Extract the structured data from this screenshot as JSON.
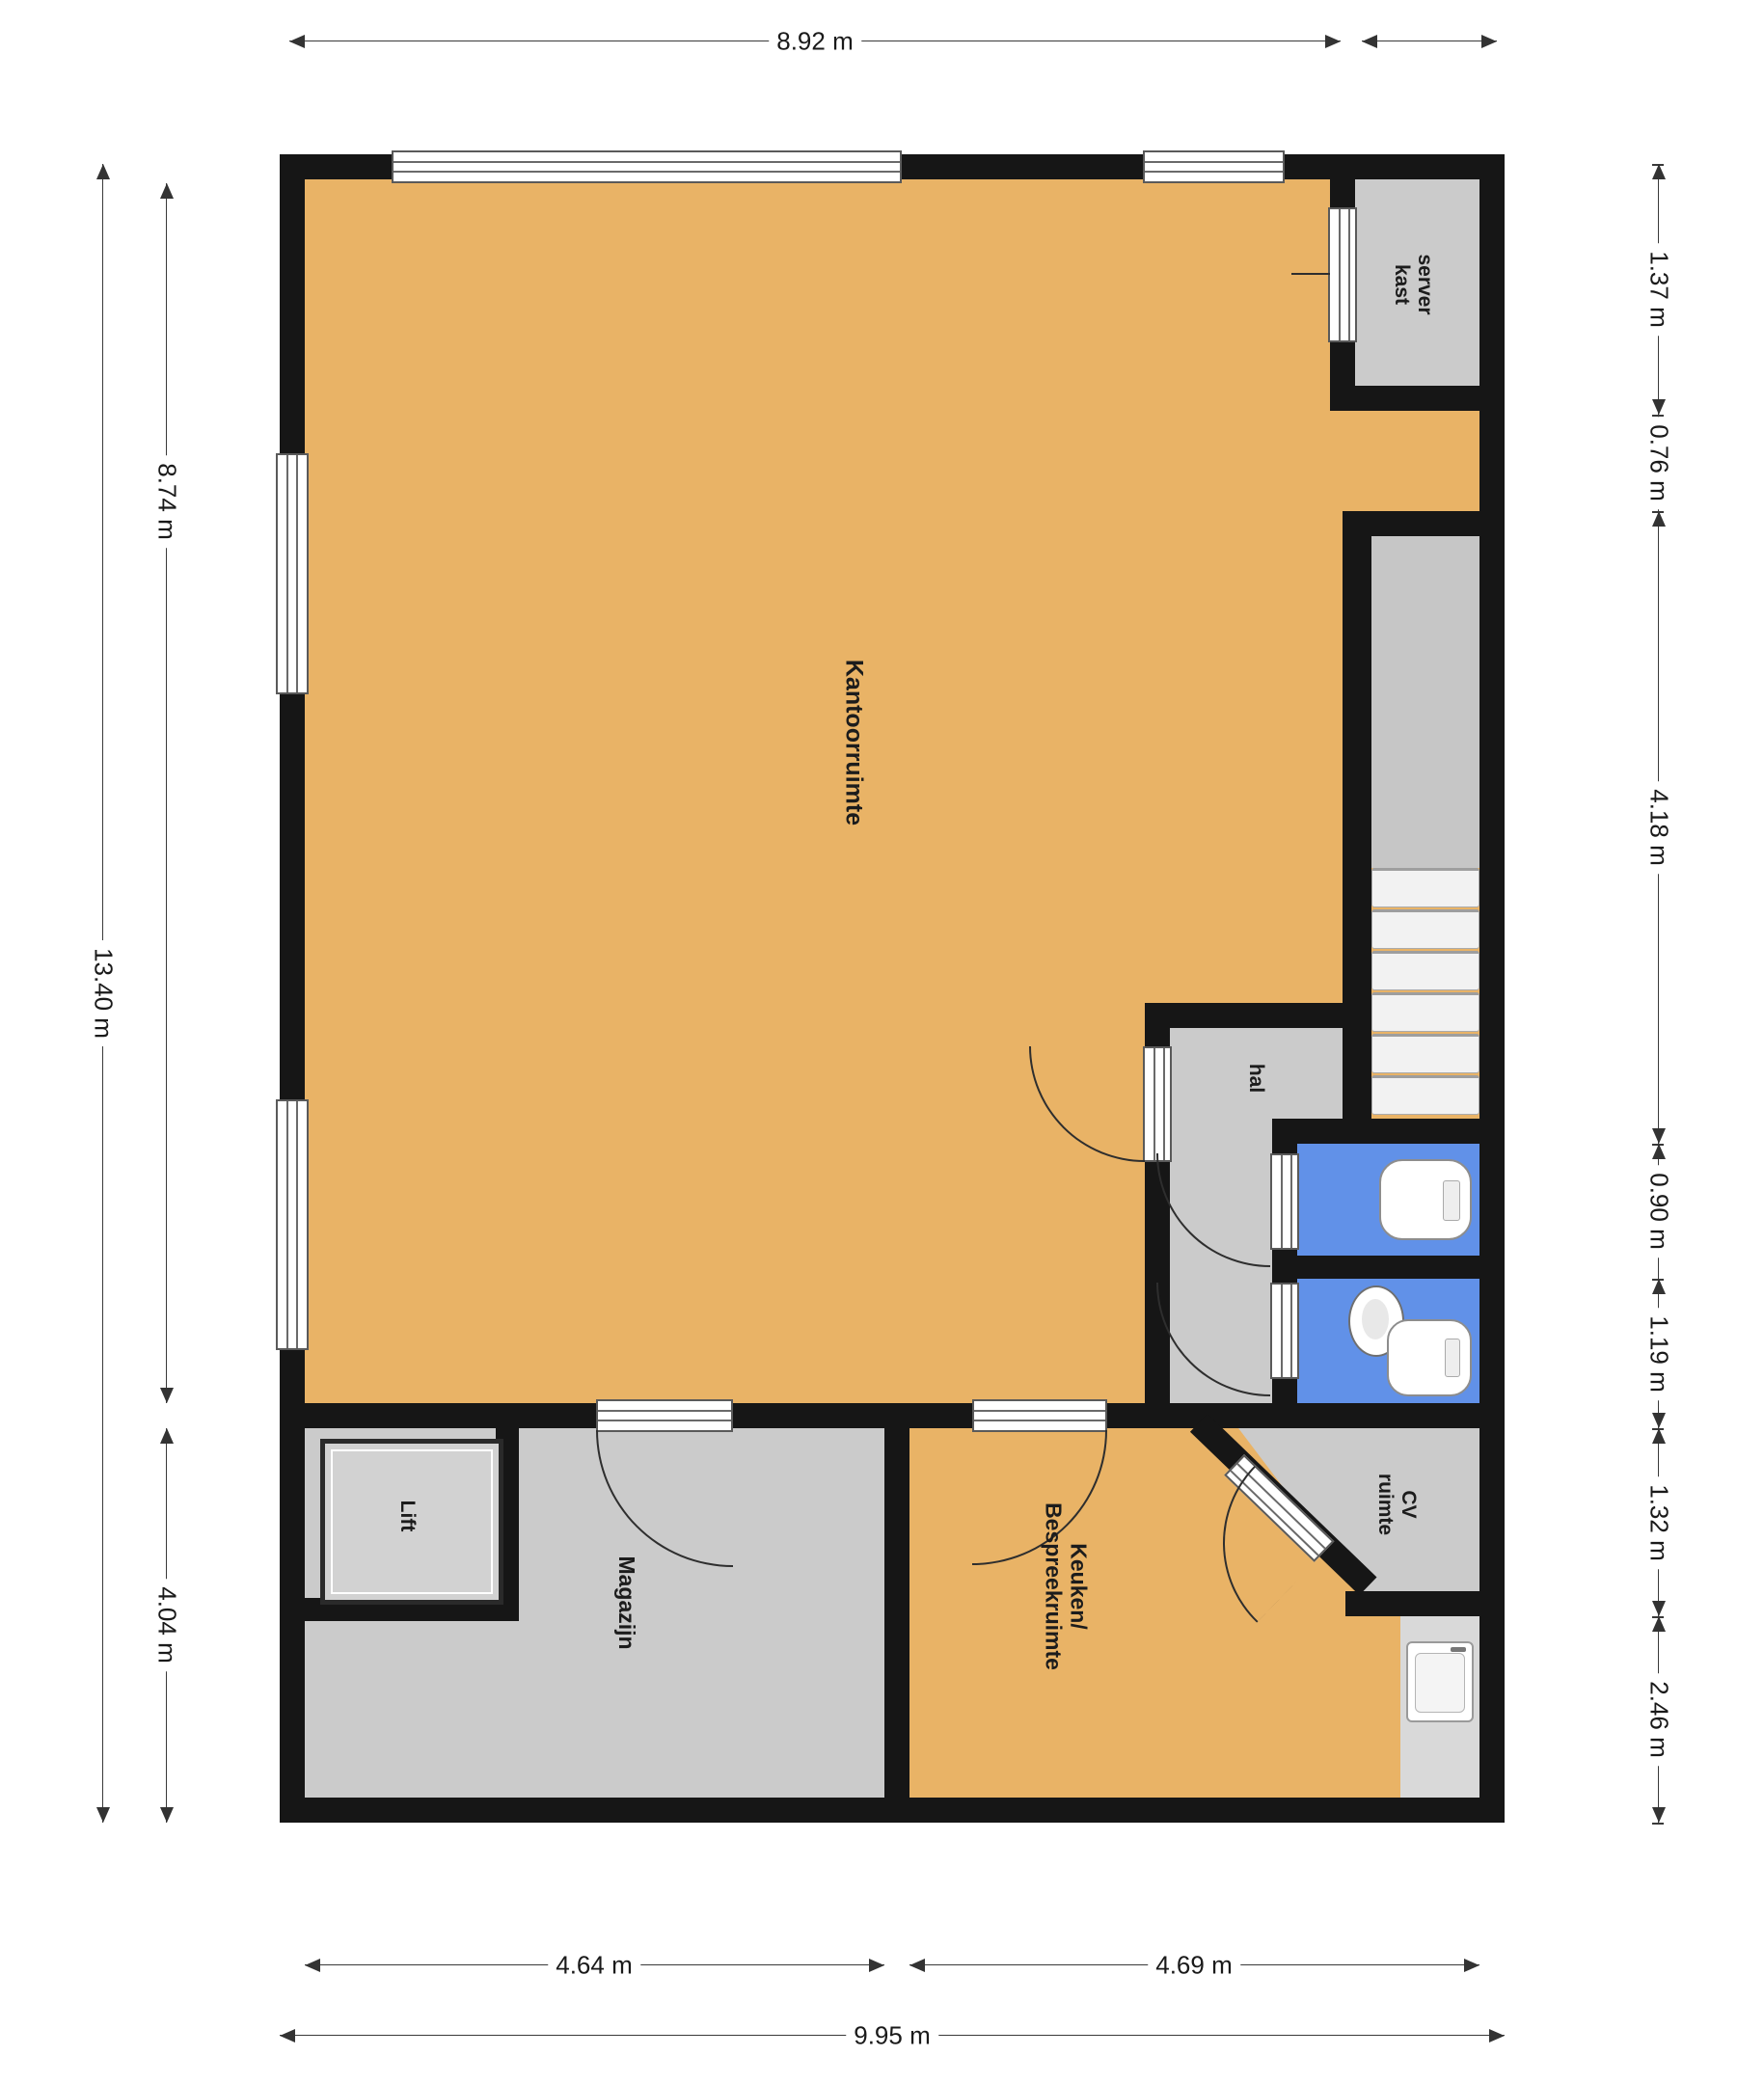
{
  "plan": {
    "rooms": {
      "kantoorruimte": "Kantoorruimte",
      "server_kast": "server\nkast",
      "hal": "hal",
      "lift": "Lift",
      "magazijn": "Magazijn",
      "keuken": "Keuken/\nBespreekruimte",
      "cv": "CV\nruimte"
    },
    "dimensions": {
      "top_width": "8.92 m",
      "left_total": "13.40 m",
      "left_upper": "8.74 m",
      "left_lower": "4.04 m",
      "right": [
        "1.37 m",
        "0.76 m",
        "4.18 m",
        "0.90 m",
        "1.19 m",
        "1.32 m",
        "2.46 m"
      ],
      "bottom_left": "4.64 m",
      "bottom_right": "4.69 m",
      "bottom_total": "9.95 m"
    },
    "colors": {
      "room_orange": "#e9b366",
      "room_gray": "#cbcbcb",
      "toilet_blue": "#6191e8",
      "counter_gray": "#d9d9d9",
      "wall": "#161616",
      "step": "#f2f2f2",
      "dim_line": "#3a3a3a",
      "text": "#1c1c1c"
    }
  }
}
